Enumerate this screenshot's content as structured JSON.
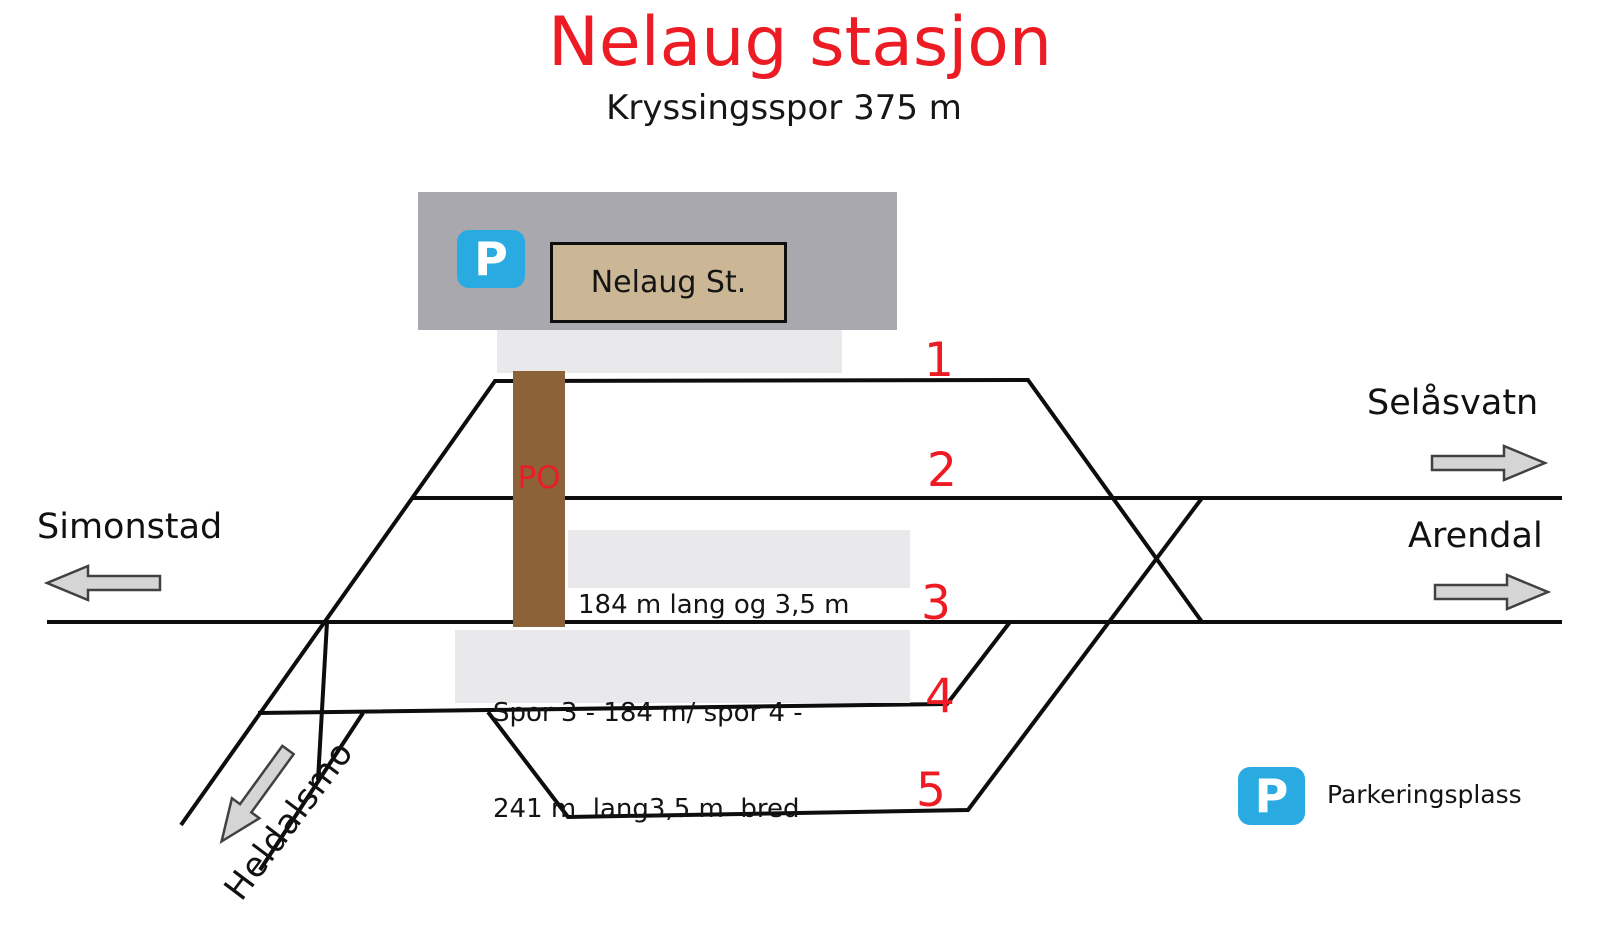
{
  "header": {
    "title": "Nelaug stasjon",
    "subtitle": "Kryssingsspor 375 m"
  },
  "station": {
    "sign": "Nelaug St.",
    "overpass_label": "PO"
  },
  "parking": {
    "symbol": "P",
    "legend_label": "Parkeringsplass"
  },
  "tracks": {
    "labels": [
      "1",
      "2",
      "3",
      "4",
      "5"
    ]
  },
  "destinations": {
    "west": "Simonstad",
    "east_upper": "Selåsvatn",
    "east_lower": "Arendal",
    "southwest": "Heldalsmo"
  },
  "notes": {
    "track2": {
      "line1": "184 m lang og 3,5 m",
      "line2": "bred"
    },
    "track3_4": {
      "line1": "Spor 3 - 184 m/ spor 4 -",
      "line2": "241 m  lang3,5 m  bred"
    }
  },
  "colors": {
    "accent_red": "#ed1c24",
    "parking_blue": "#29abe2",
    "building_gray": "#a8a8ae",
    "sign_tan": "#cbb795",
    "platform_gray": "#e9e9eb",
    "overpass_brown": "#8c6239",
    "track_black": "#0d0d0d",
    "arrow_gray": "#d5d5d5"
  }
}
